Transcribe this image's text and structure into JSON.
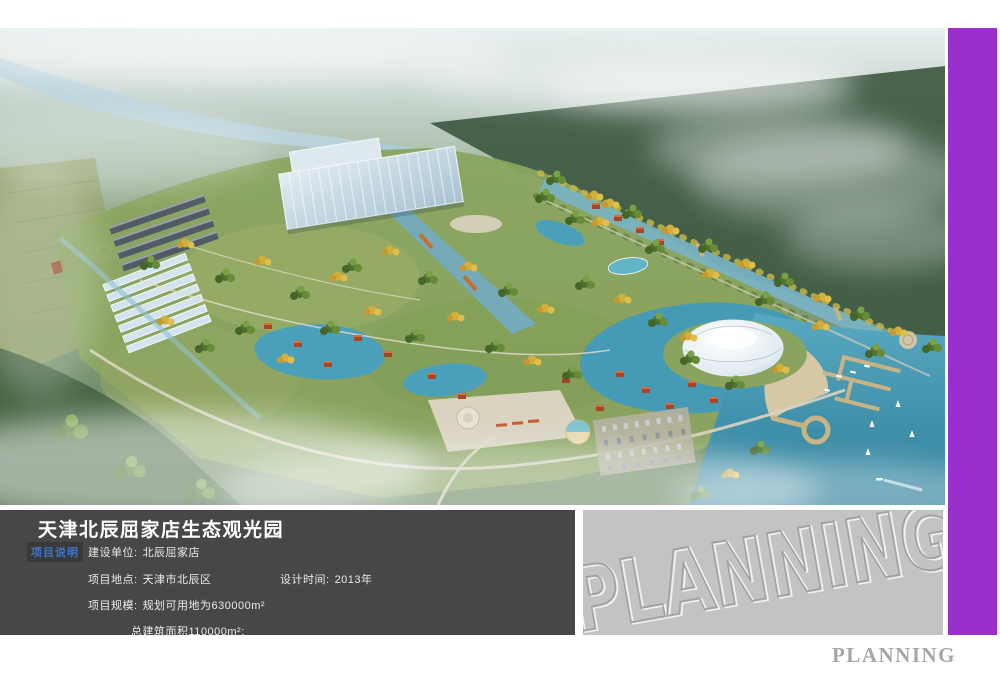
{
  "info_panel": {
    "title": "天津北辰屈家店生态观光园",
    "section_label": "项目说明",
    "fields": {
      "owner_label": "建设单位:",
      "owner_value": "北辰屈家店",
      "location_label": "项目地点:",
      "location_value": "天津市北辰区",
      "design_time_label": "设计时间:",
      "design_time_value": "2013年",
      "scale_label": "项目规模:",
      "scale_line1": "规划可用地为630000m²",
      "scale_line2": "总建筑面积110000m²;"
    }
  },
  "watermark_panel": {
    "embossed_text": "PLANNING"
  },
  "footer": {
    "brand_text": "PLANNING"
  },
  "colors": {
    "accent_purple": "#9930cd",
    "info_panel_dark": "#474747",
    "watermark_panel_gray": "#c3c3c3",
    "section_label_blue": "#3e74c9",
    "lake_teal": "#3e92ad"
  }
}
